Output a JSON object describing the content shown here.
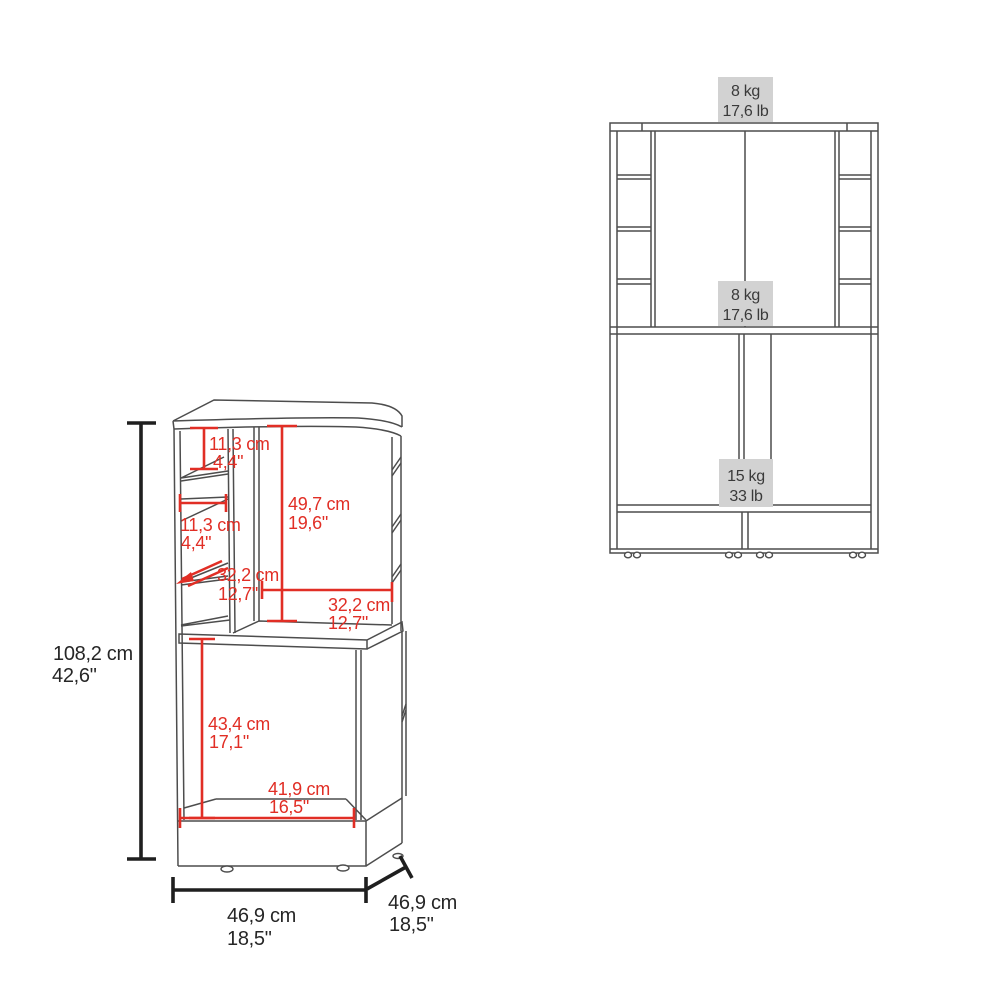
{
  "colors": {
    "dimension_red": "#e12e25",
    "dimension_black": "#1f1f1f",
    "cabinet_line": "#4d4d4d",
    "weight_label_bg": "#d2d2d2",
    "weight_label_text": "#3a3a3a",
    "background": "#ffffff"
  },
  "perspective_view": {
    "dimensions": {
      "top_shelf_height": {
        "cm": "11,3 cm",
        "inch": "4,4\""
      },
      "left_shelf_depth": {
        "cm": "11,3 cm",
        "inch": "4,4\""
      },
      "upper_cavity_height": {
        "cm": "49,7 cm",
        "inch": "19,6\""
      },
      "shelf_width": {
        "cm": "32,2 cm",
        "inch": "12,7\""
      },
      "upper_cavity_width": {
        "cm": "32,2 cm",
        "inch": "12,7\""
      },
      "lower_cavity_height": {
        "cm": "43,4 cm",
        "inch": "17,1\""
      },
      "lower_cavity_width": {
        "cm": "41,9 cm",
        "inch": "16,5\""
      },
      "overall_height": {
        "cm": "108,2 cm",
        "inch": "42,6\""
      },
      "overall_width": {
        "cm": "46,9 cm",
        "inch": "18,5\""
      },
      "overall_depth": {
        "cm": "46,9 cm",
        "inch": "18,5\""
      }
    }
  },
  "elevation_view": {
    "weights": {
      "top_surface": {
        "kg": "8 kg",
        "lb": "17,6 lb"
      },
      "middle_shelf": {
        "kg": "8 kg",
        "lb": "17,6 lb"
      },
      "cabinet_shelf": {
        "kg": "15 kg",
        "lb": "33 lb"
      }
    }
  }
}
